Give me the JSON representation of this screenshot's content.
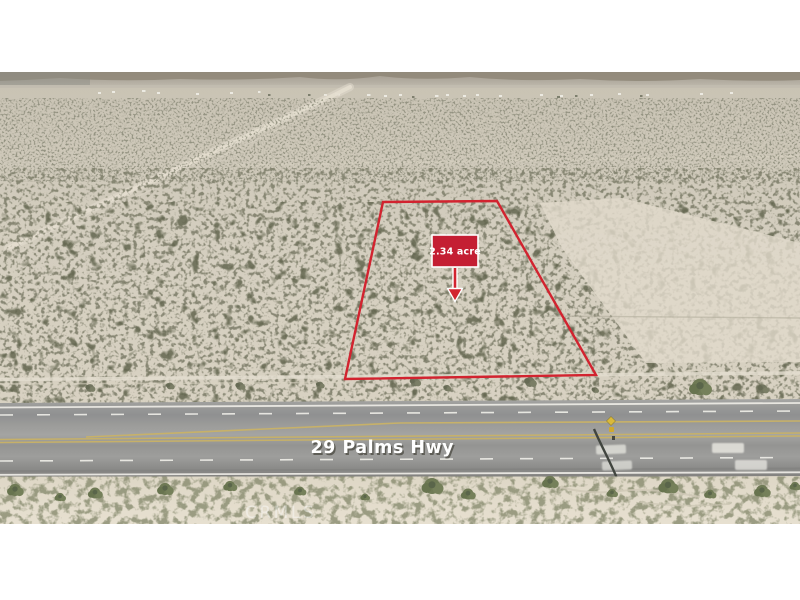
{
  "annotations": {
    "area_label": "2.34 acre",
    "road_label": "29 Palms Hwy",
    "watermark": "CRMLS"
  },
  "icons": {
    "area_pointer": "down-arrow"
  },
  "colors": {
    "parcel_red": "#d2232f",
    "label_fill": "#c41e33",
    "label_border": "#ffffff",
    "label_text": "#ffffff",
    "road_label_text": "#ffffff",
    "yellow_line": "#c9b266",
    "sand": "#d3cdbe",
    "asphalt": "#999997"
  }
}
